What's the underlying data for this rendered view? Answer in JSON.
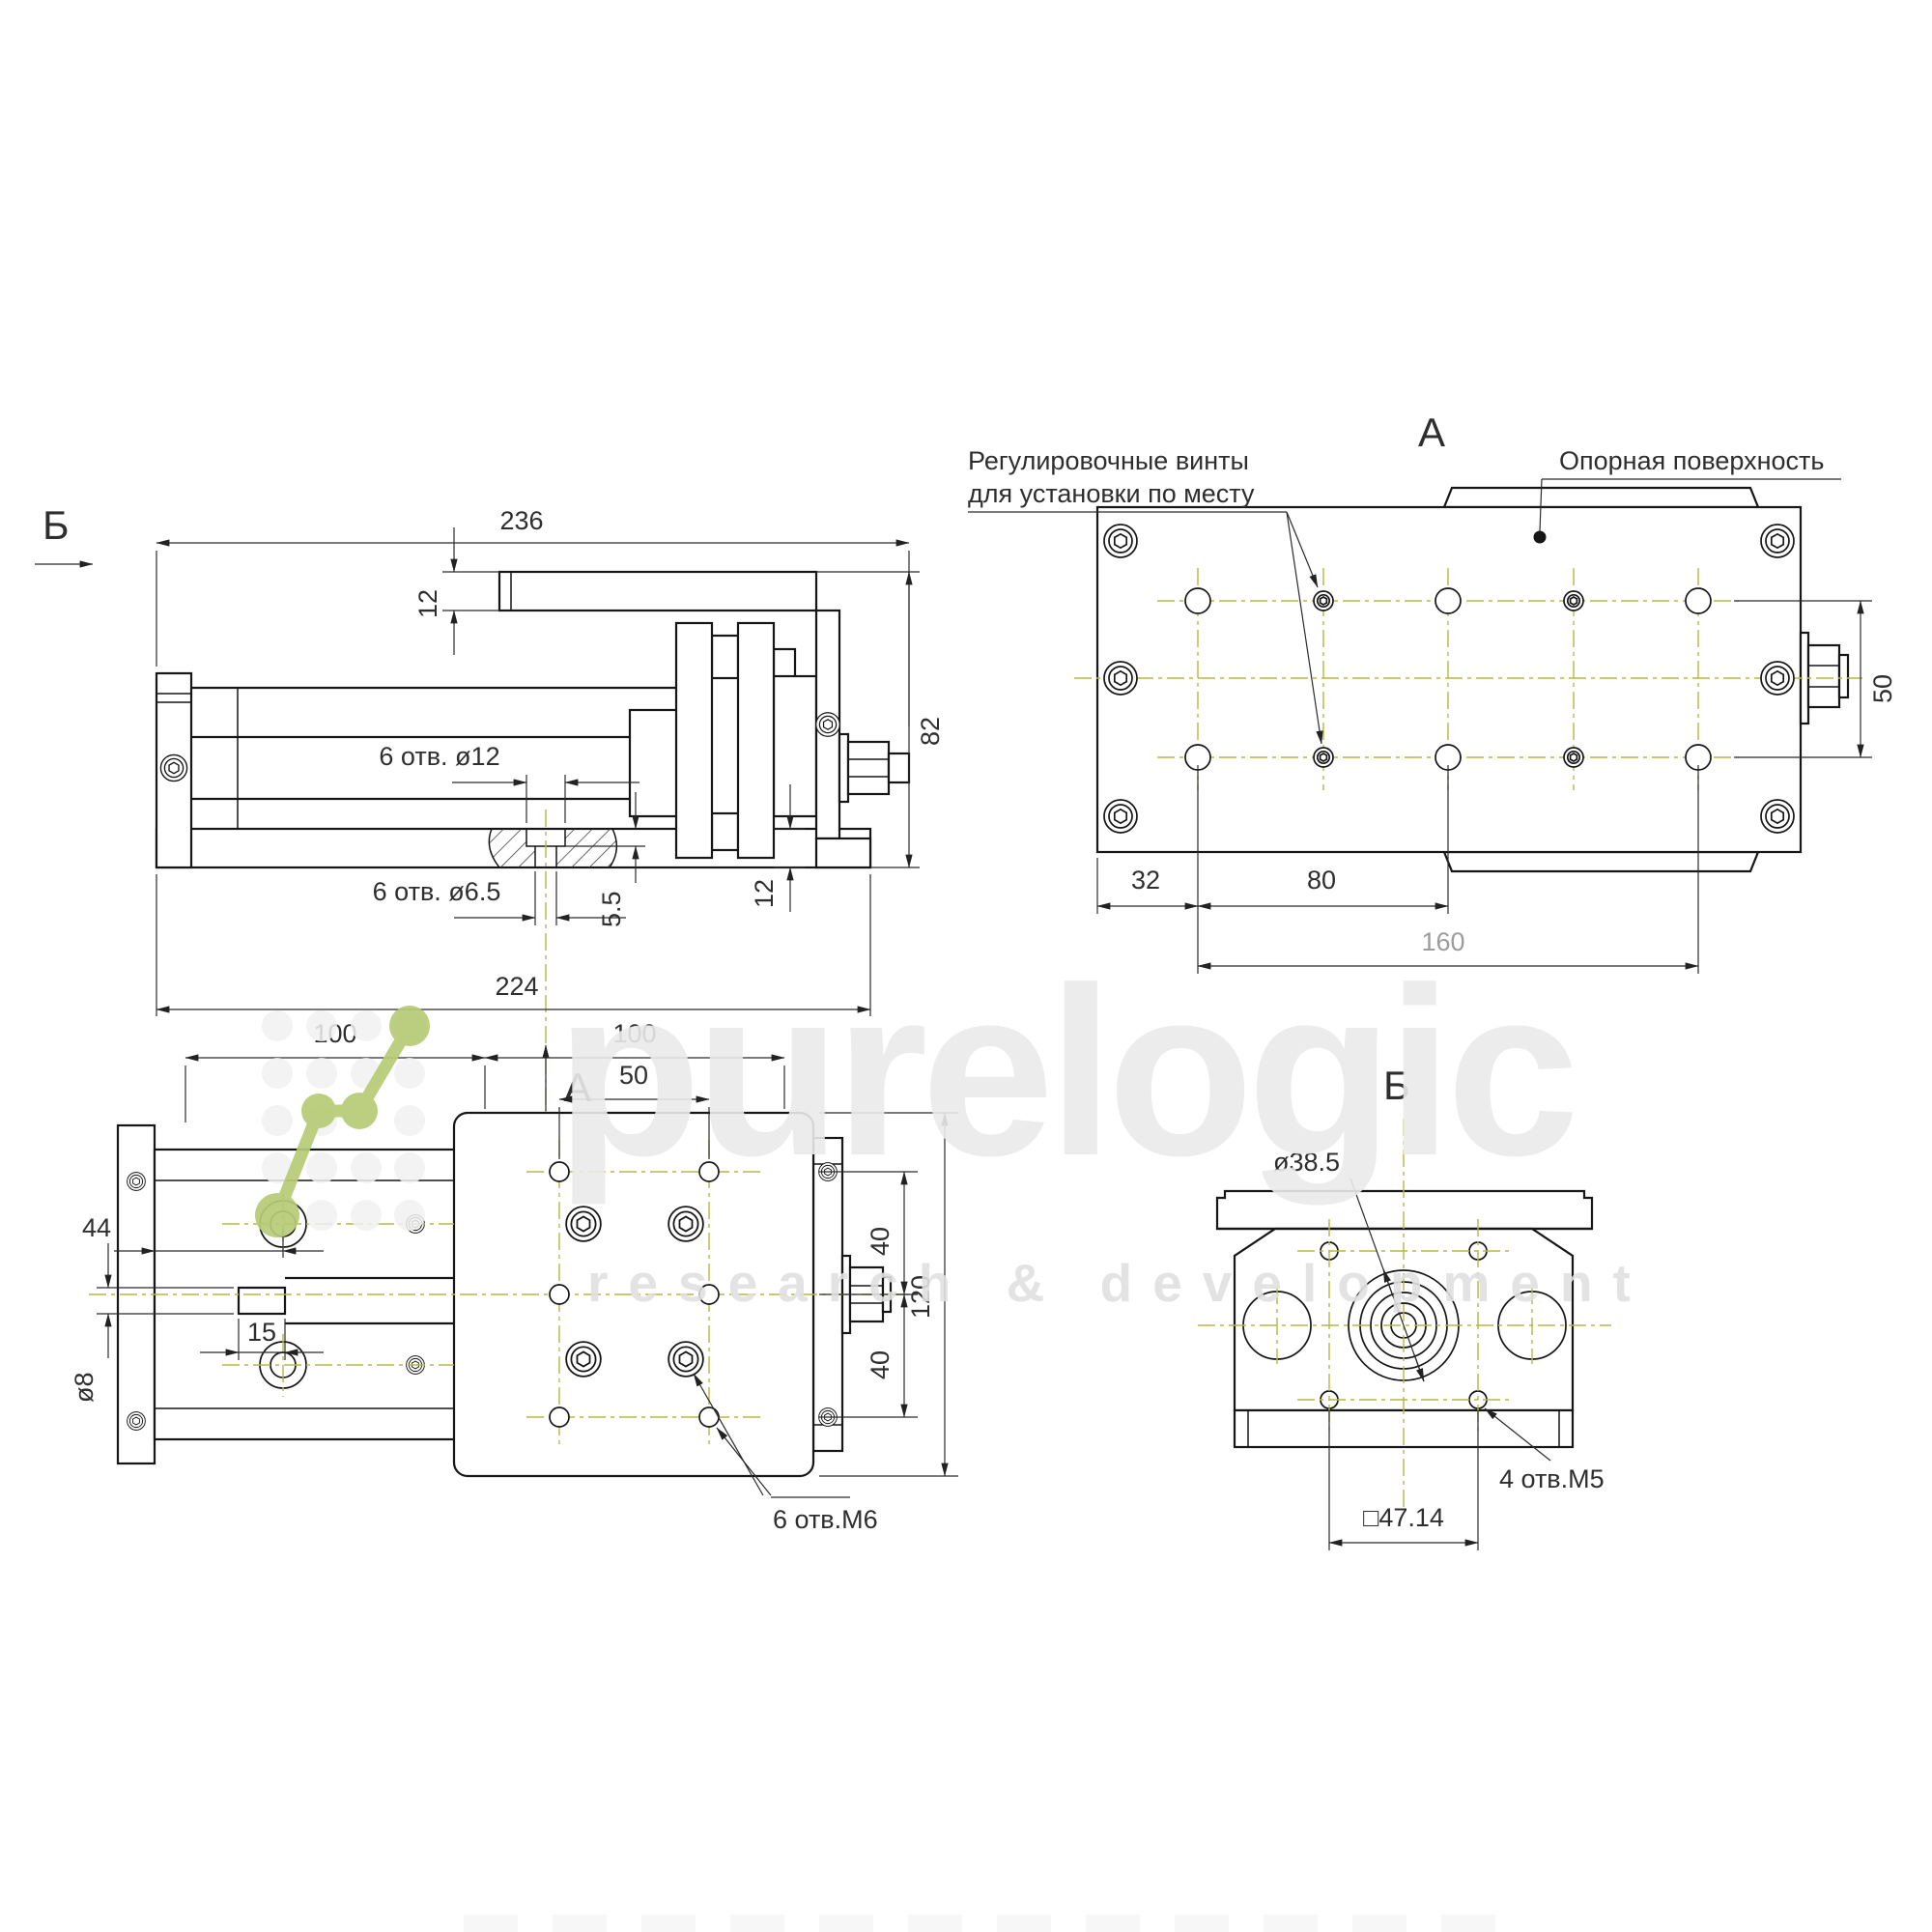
{
  "views": {
    "side": {
      "title_b": "Б",
      "dim_total": "236",
      "dim_plate_thk": "12",
      "dim_height": "82",
      "dim_base_thk": "12",
      "dim_cbore_depth": "5.5",
      "dim_pattern": "224",
      "holes_big": "6 отв. ø12",
      "holes_small": "6 отв. ø6.5",
      "arrow_a": "А"
    },
    "a": {
      "title": "А",
      "callout_adjust_l1": "Регулировочные винты",
      "callout_adjust_l2": "для установки по месту",
      "callout_surface": "Опорная поверхность",
      "dim_edge": "32",
      "dim_step": "80",
      "dim_span": "160",
      "dim_rows": "50"
    },
    "plan": {
      "dim_left": "100",
      "dim_right": "100",
      "dim_cols": "50",
      "dim_stub_pos": "44",
      "dim_stub_len": "15",
      "dim_shaft": "ø8",
      "dim_row_top": "40",
      "dim_row_bot": "40",
      "dim_width": "120",
      "holes": "6 отв.М6"
    },
    "b": {
      "title": "Б",
      "dim_boss": "ø38.5",
      "dim_square": "□47.14",
      "holes": "4 отв.М5"
    }
  },
  "watermark": {
    "brand": "purelogic",
    "subtitle": "research & development"
  },
  "colors": {
    "line": "#161616",
    "centerline": "#b3b944",
    "logo_green": "#b7cb77",
    "dim_gray": "#9c9c9c"
  }
}
